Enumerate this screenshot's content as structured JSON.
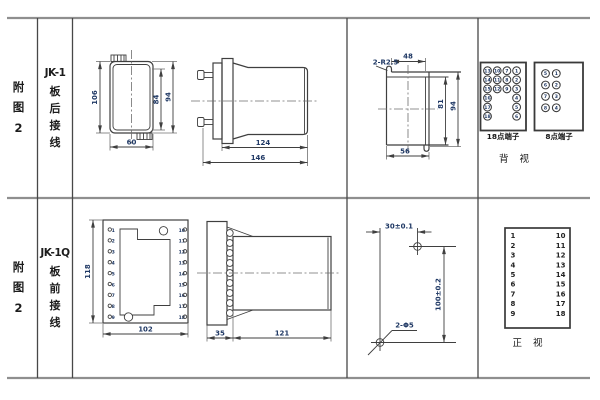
{
  "style": {
    "line_color": "#3f3f3f",
    "dim_text_color": "#1f3864",
    "grid_color": "#8f8f8f",
    "background": "#ffffff"
  },
  "labels": {
    "top_figure": [
      "附",
      "图",
      "2"
    ],
    "top_model": "JK-1",
    "top_wiring": [
      "板",
      "后",
      "接",
      "线"
    ],
    "bottom_figure": [
      "附",
      "图",
      "2"
    ],
    "bottom_model": "JK-1Q",
    "bottom_wiring": [
      "板",
      "前",
      "接",
      "线"
    ]
  },
  "top": {
    "front": {
      "h": "106",
      "w": "60",
      "inner": "84",
      "outer": "94"
    },
    "side": {
      "depth": "124",
      "total": "146"
    },
    "cutout": {
      "r": "2-R2.5",
      "top": "48",
      "inner": "81",
      "outer": "94",
      "bottom": "56"
    },
    "t18_label": "18点端子",
    "t8_label": "8点端子",
    "rear_label": "背 视",
    "t18": [
      "13",
      "10",
      "7",
      "1",
      "14",
      "11",
      "8",
      "2",
      "15",
      "12",
      "9",
      "3",
      "16",
      "4",
      "17",
      "5",
      "18",
      "6"
    ],
    "t8": [
      "5",
      "1",
      "6",
      "2",
      "7",
      "3",
      "8",
      "4"
    ]
  },
  "bottom": {
    "front": {
      "h": "118",
      "w": "102",
      "left": [
        "1",
        "2",
        "3",
        "4",
        "5",
        "6",
        "7",
        "8",
        "9"
      ],
      "right": [
        "10",
        "11",
        "12",
        "13",
        "14",
        "15",
        "16",
        "17",
        "18"
      ]
    },
    "side": {
      "flange": "35",
      "depth": "121"
    },
    "drill": {
      "dx": "30±0.1",
      "dy": "100±0.2",
      "holes": "2-Φ5"
    },
    "table_left": [
      "1",
      "2",
      "3",
      "4",
      "5",
      "6",
      "7",
      "8",
      "9"
    ],
    "table_right": [
      "10",
      "11",
      "12",
      "13",
      "14",
      "15",
      "16",
      "17",
      "18"
    ],
    "front_label": "正 视"
  }
}
